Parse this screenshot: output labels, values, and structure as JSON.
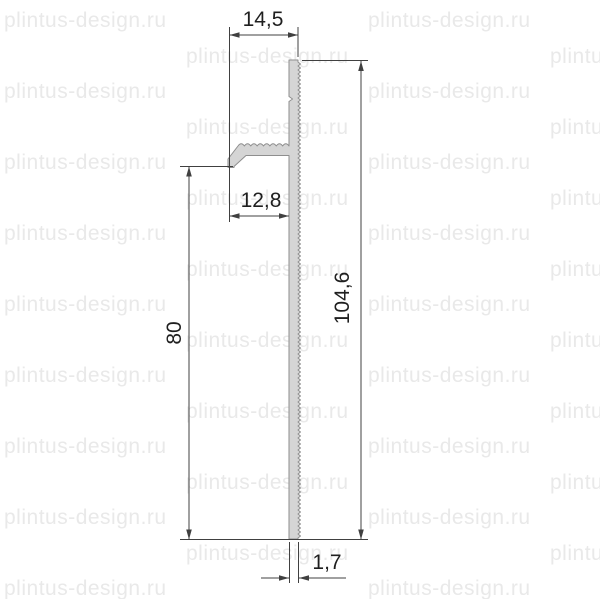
{
  "page": {
    "background": "#ffffff"
  },
  "watermark": {
    "text": "plintus-design.ru",
    "color": "#e9e9e9"
  },
  "drawing": {
    "kind": "skirting-profile-cross-section",
    "dimensions": {
      "top_width": "14,5",
      "arm_width": "12,8",
      "left_height": "80",
      "right_height": "104,6",
      "thickness": "1,7"
    },
    "colors": {
      "profile_fill": "#d5d5d5",
      "profile_outline": "#8e8e8e",
      "dimension_line": "#404040",
      "label_text": "#1f1f1f"
    }
  }
}
